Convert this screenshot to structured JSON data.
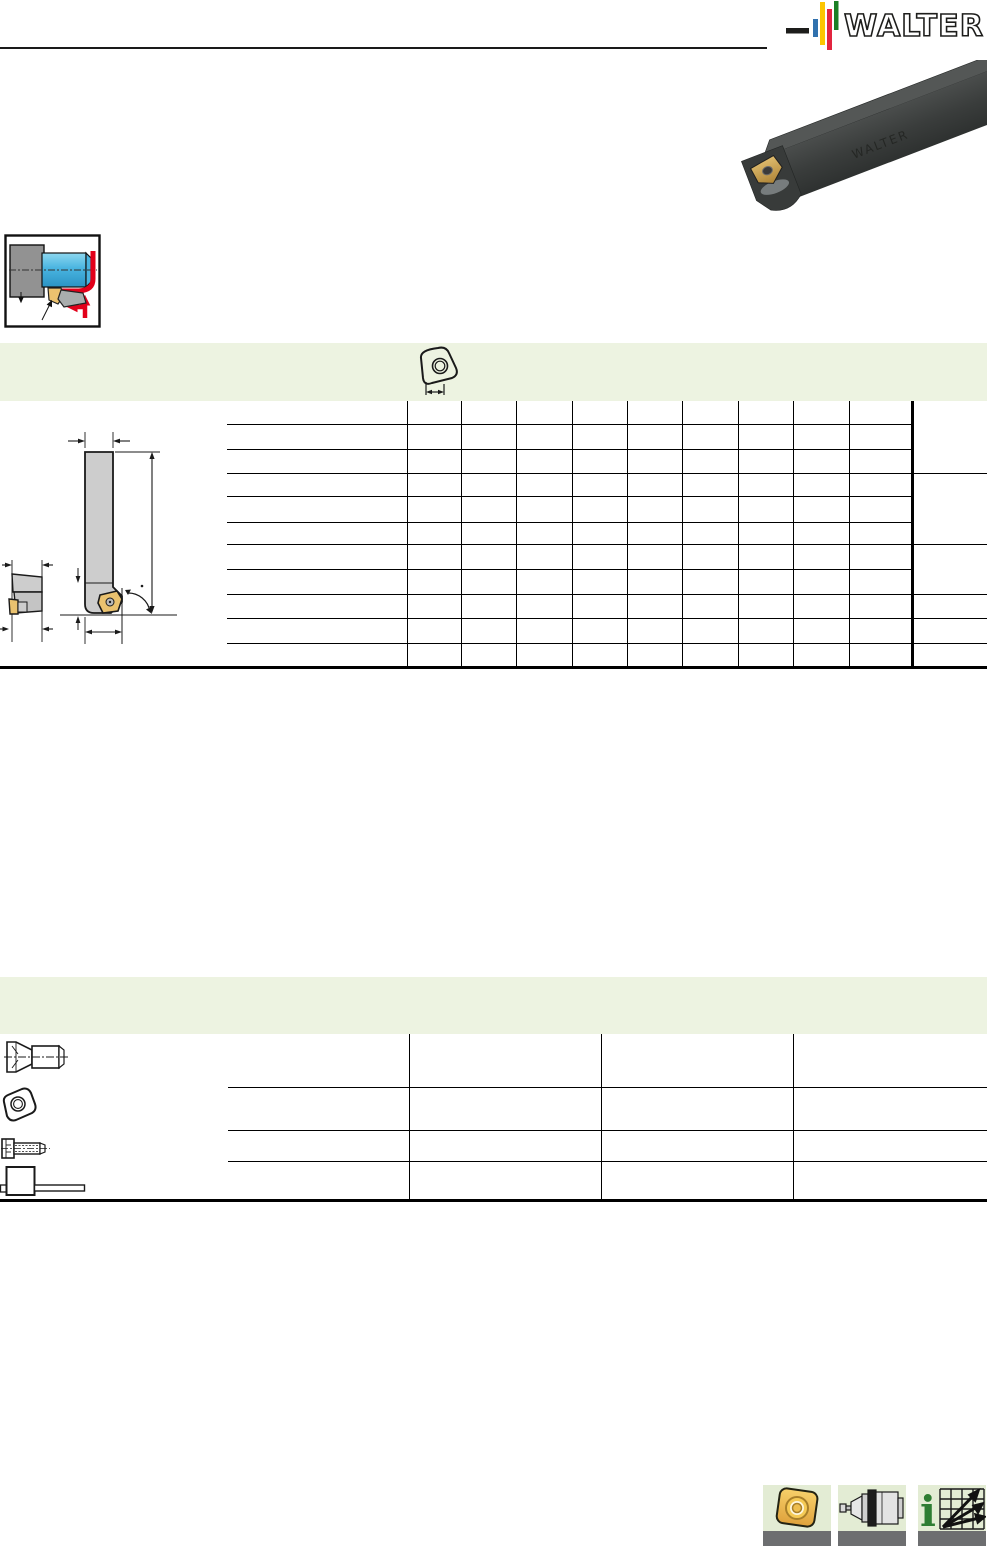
{
  "header": {
    "brand": "WALTER",
    "logo": {
      "dash_color": "#1d1d1b",
      "bar_colors": [
        "#3071ae",
        "#fdc500",
        "#e2243f",
        "#1b7f24"
      ],
      "text_color": "#1d1d1b"
    },
    "rule_color": "#1a1a1a"
  },
  "product_photo": {
    "name": "square-shank-toolholder-with-trigon-insert",
    "body_color": "#3c3f3e",
    "insert_color": "#d8b264"
  },
  "application_pictogram": {
    "name": "external-longitudinal-turning",
    "workpiece_color": "#49b4e0",
    "chuck_color": "#929292",
    "feed_arrow_color": "#e2001a"
  },
  "section_banners": {
    "color": "#edf3e1",
    "first": {
      "icon": "trigon-insert-dimension-icon"
    }
  },
  "spec_table": {
    "row_count": 11,
    "data_column_count": 10,
    "has_merged_right_column": true,
    "cells_empty": true
  },
  "parts_table": {
    "row_count": 4,
    "column_count": 3,
    "cells_empty": true,
    "row_icons": [
      "countersunk-screw-icon",
      "trigon-insert-icon",
      "clamping-screw-icon",
      "torque-wrench-icon"
    ]
  },
  "technical_drawing": {
    "views": [
      "side-view",
      "front-view"
    ],
    "body_color": "#cdcdcd",
    "insert_color": "#eac26f"
  },
  "footer_icons": {
    "tile_bg": "#e3ecd4",
    "bar_color": "#6d6e70",
    "tiles": [
      {
        "name": "indexable-insert-icon",
        "glyph": ""
      },
      {
        "name": "tool-adapter-icon",
        "glyph": ""
      },
      {
        "name": "cutting-data-info-icon",
        "glyph": "i"
      }
    ]
  }
}
